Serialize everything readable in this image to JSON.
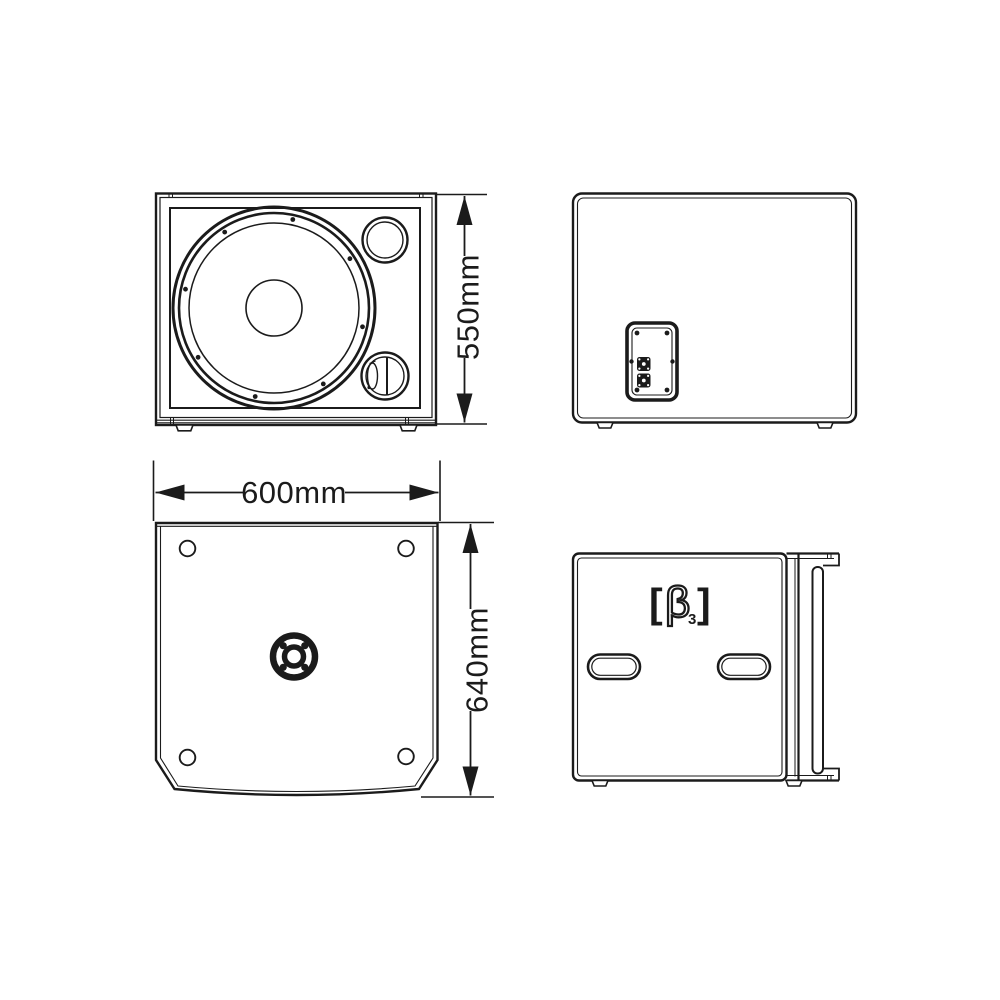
{
  "colors": {
    "line": "#1b1b1b",
    "background": "#ffffff"
  },
  "dimensions": {
    "height_label": "550mm",
    "width_label": "600mm",
    "depth_label": "640mm"
  },
  "logo": {
    "text": "[β3]",
    "bracket_left": "[",
    "beta": "β",
    "subscript": "3",
    "bracket_right": "]"
  }
}
